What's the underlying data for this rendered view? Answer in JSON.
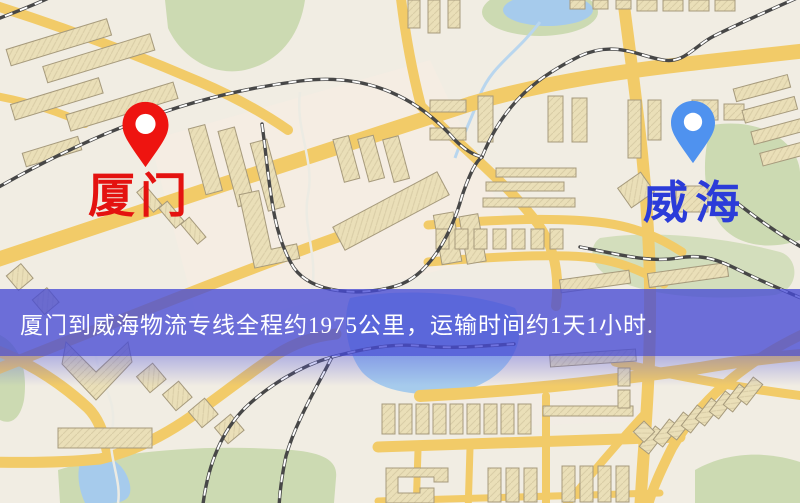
{
  "banner": {
    "text": "厦门到威海物流专线全程约1975公里，运输时间约1天1小时.",
    "background_color": "#474ad5",
    "text_color": "#ffffff"
  },
  "markers": {
    "origin": {
      "label": "厦门",
      "pin_color": "#ee1410",
      "label_color": "#e41210"
    },
    "destination": {
      "label": "威海",
      "pin_color": "#4f92ef",
      "label_color": "#2b3cd9"
    }
  },
  "map": {
    "background_color": "#f1ede3",
    "road_color": "#f2cb68",
    "building_color": "#eadfb8",
    "park_color": "#ccdab2",
    "water_color": "#a6cbec",
    "railway_color": "#474747"
  }
}
